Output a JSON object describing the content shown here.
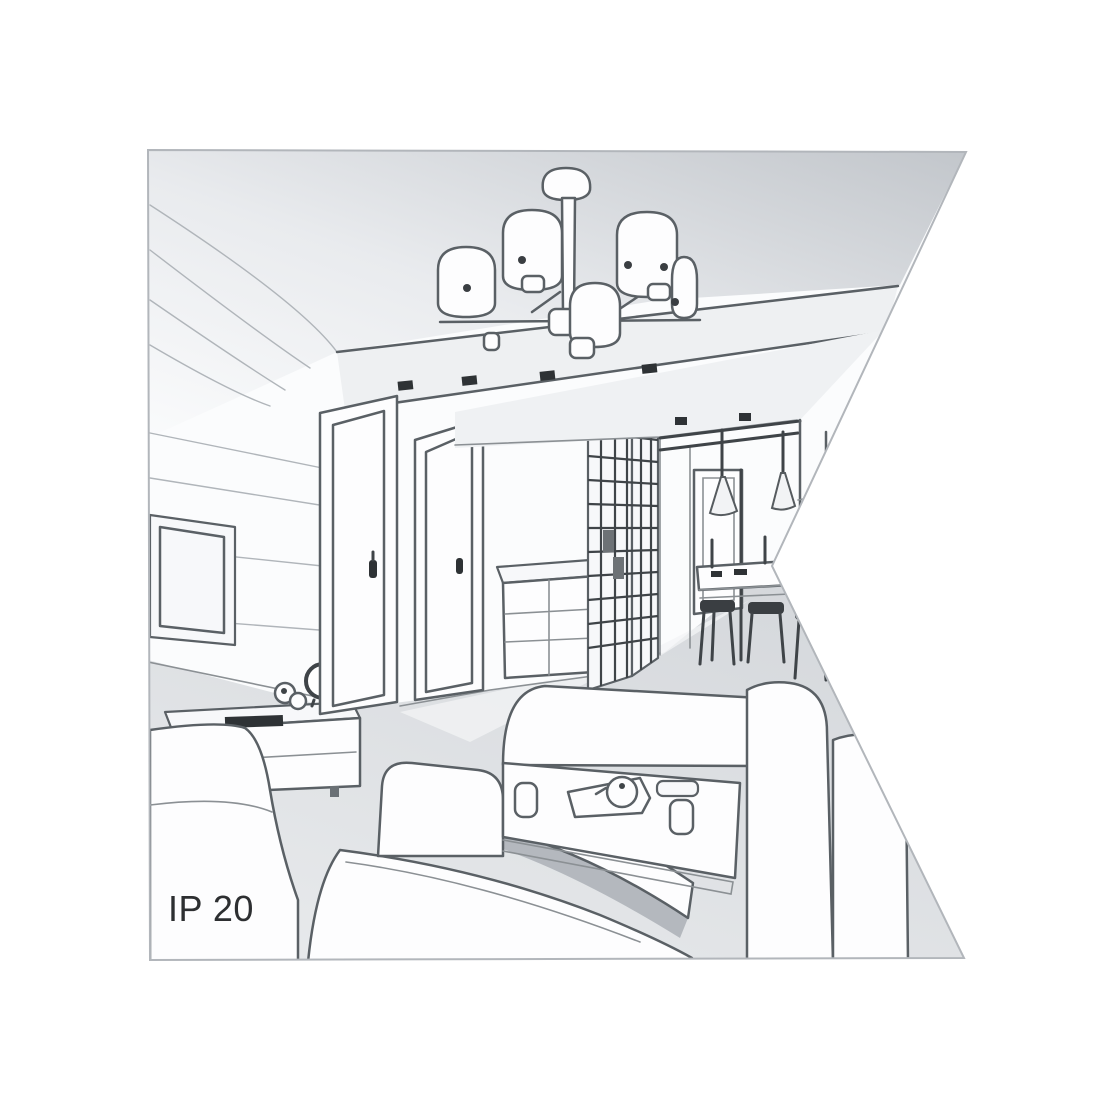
{
  "label": {
    "ip_rating": "IP 20"
  },
  "scene": {
    "type": "interior-line-drawing",
    "description": "Grayscale perspective sketch of a living room interior featuring a six-shade ceiling chandelier, doors, wardrobe, dining nook with cone pendants, corner sofa and coffee table",
    "objects": [
      "chandelier-icon",
      "sofa",
      "corner-sofa",
      "coffee-table",
      "tv-frame",
      "tv-cabinet",
      "clock",
      "door",
      "door",
      "drawer-chest",
      "glazed-wardrobe",
      "hallway",
      "dining-table",
      "bar-stool",
      "pendant-lamp",
      "ceiling-spotlight"
    ]
  },
  "colors": {
    "background": "#ffffff",
    "line": "#5a6065",
    "line_dark": "#3f4448",
    "ceiling_gray": "#c5c9cd",
    "floor_gray": "#dcdfe2",
    "shadow": "#b4b8be",
    "text": "#2d2f31"
  }
}
